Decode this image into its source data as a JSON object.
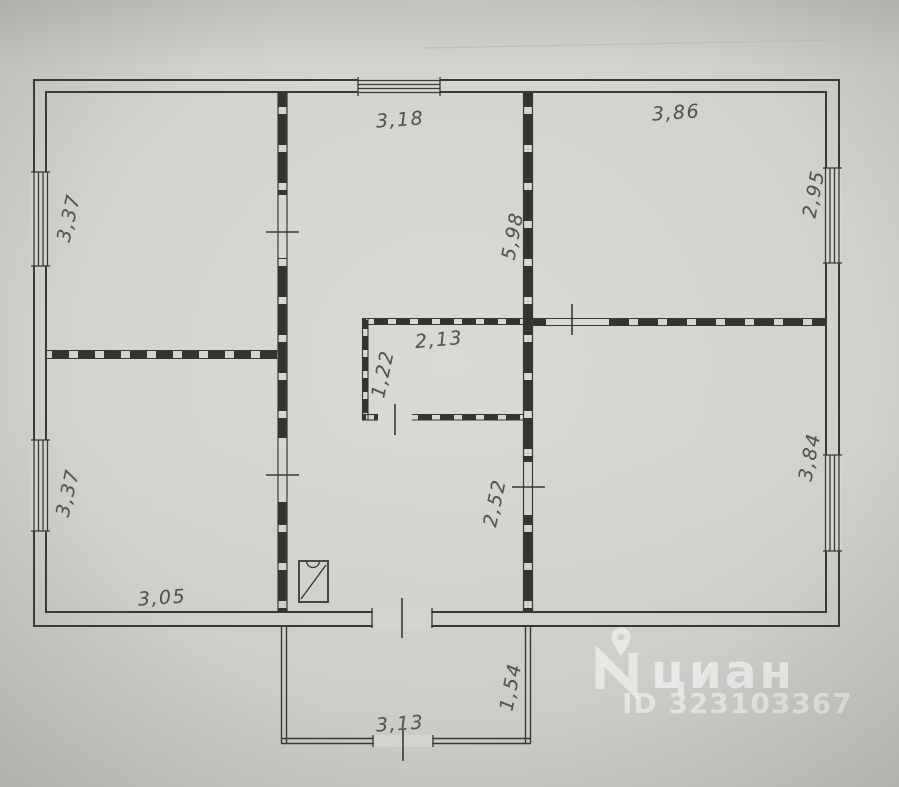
{
  "photo": {
    "background": "#d3d1cd",
    "ink": "#3a3936",
    "dimension_color": "#55534e"
  },
  "floorplan": {
    "dimensions": [
      {
        "text": "3,18",
        "x": 400,
        "y": 120,
        "rot": -4
      },
      {
        "text": "3,86",
        "x": 676,
        "y": 113,
        "rot": -4
      },
      {
        "text": "3,37",
        "x": 69,
        "y": 218,
        "rot": -77
      },
      {
        "text": "2,95",
        "x": 814,
        "y": 194,
        "rot": -79
      },
      {
        "text": "5,98",
        "x": 513,
        "y": 236,
        "rot": -79
      },
      {
        "text": "2,13",
        "x": 439,
        "y": 340,
        "rot": -5
      },
      {
        "text": "1,22",
        "x": 383,
        "y": 374,
        "rot": -78
      },
      {
        "text": "3,37",
        "x": 68,
        "y": 493,
        "rot": -77
      },
      {
        "text": "2,52",
        "x": 495,
        "y": 503,
        "rot": -78
      },
      {
        "text": "3,84",
        "x": 810,
        "y": 457,
        "rot": -79
      },
      {
        "text": "3,05",
        "x": 162,
        "y": 598,
        "rot": -4
      },
      {
        "text": "1,54",
        "x": 511,
        "y": 687,
        "rot": -79
      },
      {
        "text": "3,13",
        "x": 400,
        "y": 724,
        "rot": -4
      }
    ]
  },
  "watermark": {
    "logo_icon": "cian-pin-logo-icon",
    "brand_text": "циан",
    "listing_id": "ID 323103367"
  }
}
